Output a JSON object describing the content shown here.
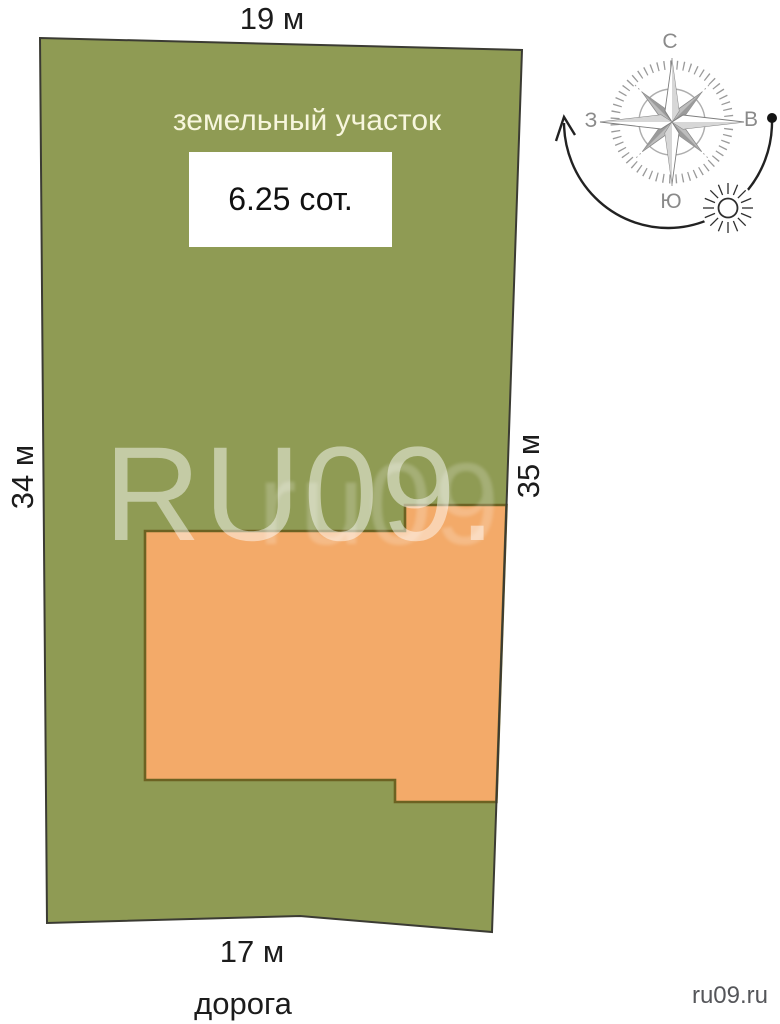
{
  "figure": {
    "title": "земельный участок",
    "area_label": "6.25 сот.",
    "dimensions": {
      "top": "19 м",
      "left": "34 м",
      "right": "35 м",
      "bottom": "17 м"
    },
    "road_label": "дорога",
    "credit": "ru09.ru",
    "watermark": {
      "primary": "RU09.",
      "secondary": "ru09.ru"
    }
  },
  "compass": {
    "north": "С",
    "east": "В",
    "south": "Ю",
    "west": "З"
  },
  "icons": {
    "compass_rose": "compass-rose-icon",
    "sun": "sun-icon",
    "sun_path_arrow": "sun-path-arrow-icon",
    "east_dot": "east-dot-icon"
  },
  "colors": {
    "plot_fill": "#8f9b54",
    "plot_border": "#3b3b33",
    "building_fill": "#f3aa69",
    "building_border": "#6c6222",
    "title_text": "#f7f6dd",
    "label_text": "#1c1c1c",
    "compass_gray": "#8a8a8a",
    "credit_text": "#55565a"
  }
}
